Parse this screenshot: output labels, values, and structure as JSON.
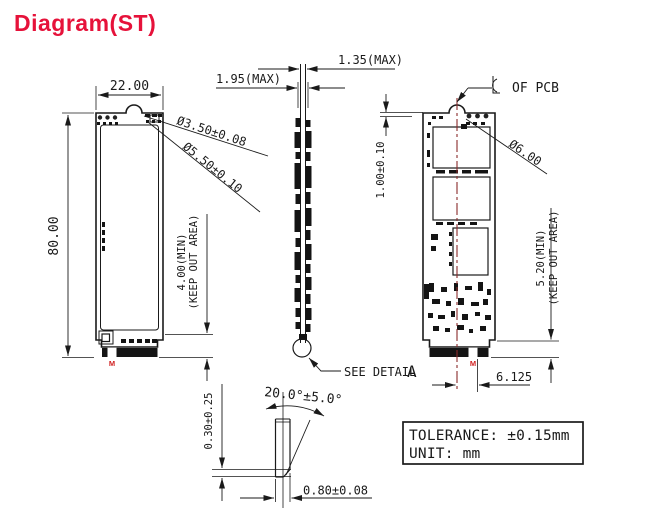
{
  "title": "Diagram(ST)",
  "colors": {
    "title": "#e6123a",
    "line": "#1a1a1a",
    "centerline": "#8a2b2b",
    "key_marker": "#d02020",
    "background": "#ffffff"
  },
  "views": {
    "front": {
      "width_dim": "22.00",
      "height_dim": "80.00",
      "hole_callout_small": "Ø3.50±0.08",
      "hole_callout_large": "Ø5.50±0.10",
      "keepout_dim": "4.00(MIN)",
      "keepout_label": "(KEEP OUT AREA)",
      "key_marker": "M"
    },
    "side": {
      "thickness_pcb_dim": "1.35(MAX)",
      "thickness_total_dim": "1.95(MAX)",
      "detail_note": "SEE DETAIL",
      "detail_ref": "A"
    },
    "back": {
      "centerline_symbol": "℄",
      "centerline_label": "OF PCB",
      "hole_callout": "Ø6.00",
      "hole_offset_dim": "1.00±0.10",
      "keepout_dim": "5.20(MIN)",
      "keepout_label": "(KEEP OUT AREA)",
      "key_offset_dim": "6.125",
      "key_marker": "M"
    },
    "detail_a": {
      "angle_dim": "20.0°±5.0°",
      "thickness_dim": "0.30±0.25",
      "width_dim": "0.80±0.08"
    }
  },
  "notes": {
    "tolerance": "TOLERANCE: ±0.15mm",
    "unit": "UNIT: mm"
  }
}
